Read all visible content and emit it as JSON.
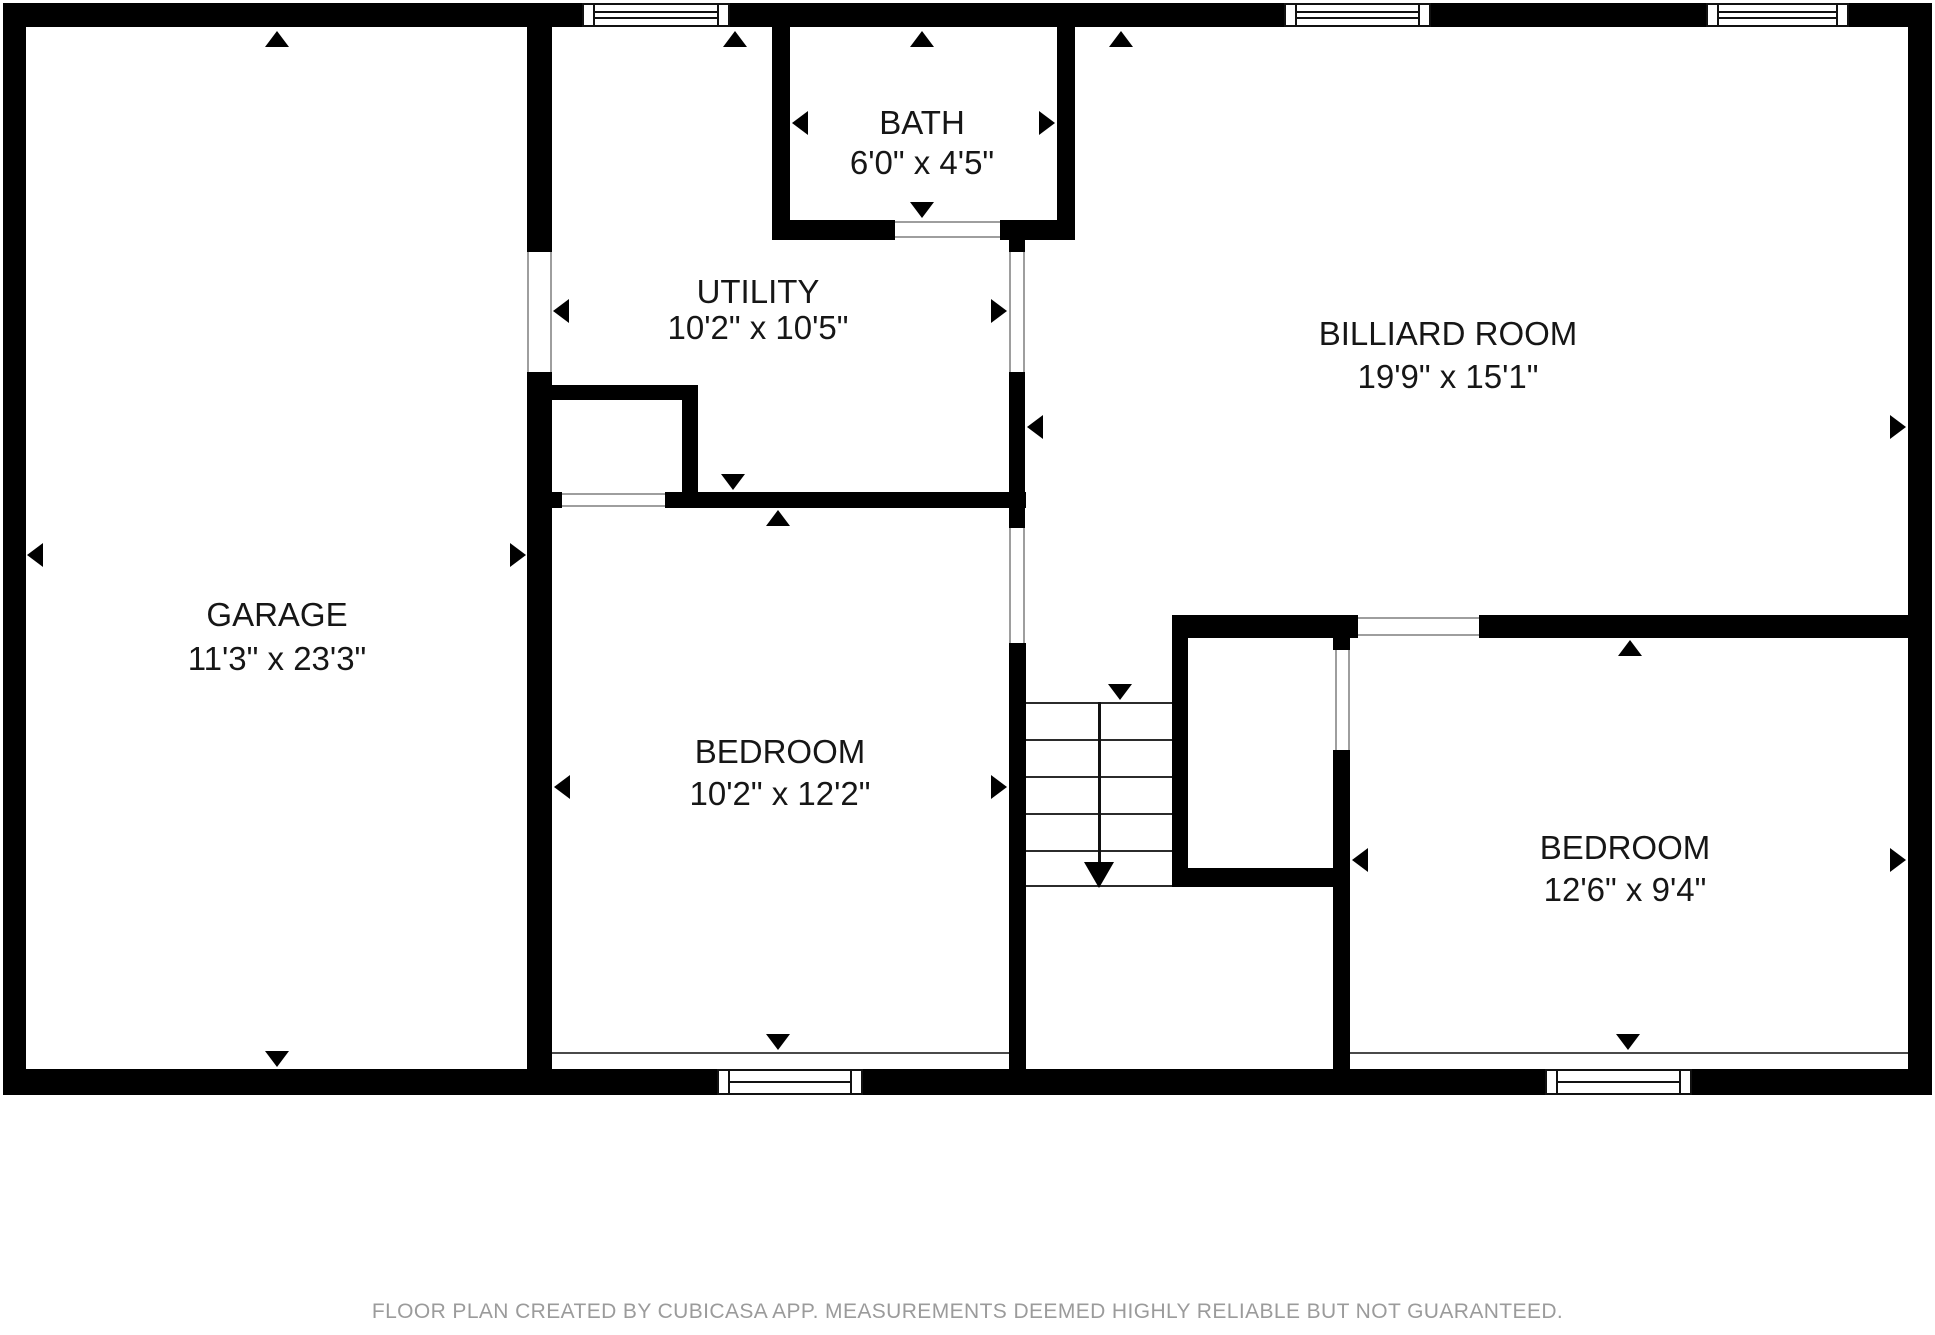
{
  "footer": {
    "text": "FLOOR PLAN CREATED BY CUBICASA APP. MEASUREMENTS DEEMED HIGHLY RELIABLE BUT NOT GUARANTEED.",
    "y": 1300
  },
  "colors": {
    "wall": "#000000",
    "background": "#ffffff",
    "label": "#161616",
    "footer_text": "#9b9b9b",
    "opening_line": "#9e9e9e",
    "floor_line": "#4a4a4a"
  },
  "canvas": {
    "width": 1935,
    "height": 1335
  },
  "plan": {
    "rooms": [
      {
        "id": "garage",
        "name": "GARAGE",
        "dims": "11'3\" x 23'3\"",
        "cx": 277,
        "name_y": 615,
        "dims_y": 659
      },
      {
        "id": "utility",
        "name": "UTILITY",
        "dims": "10'2\" x 10'5\"",
        "cx": 758,
        "name_y": 292,
        "dims_y": 328
      },
      {
        "id": "bath",
        "name": "BATH",
        "dims": "6'0\" x 4'5\"",
        "cx": 922,
        "name_y": 123,
        "dims_y": 163
      },
      {
        "id": "billiard-room",
        "name": "BILLIARD ROOM",
        "dims": "19'9\" x 15'1\"",
        "cx": 1448,
        "name_y": 334,
        "dims_y": 377
      },
      {
        "id": "bedroom-left",
        "name": "BEDROOM",
        "dims": "10'2\" x 12'2\"",
        "cx": 780,
        "name_y": 752,
        "dims_y": 794
      },
      {
        "id": "bedroom-right",
        "name": "BEDROOM",
        "dims": "12'6\" x 9'4\"",
        "cx": 1625,
        "name_y": 848,
        "dims_y": 890
      }
    ],
    "walls": [
      [
        3,
        3,
        579,
        24
      ],
      [
        730,
        3,
        554,
        24
      ],
      [
        1431,
        3,
        275,
        24
      ],
      [
        1849,
        3,
        83,
        24
      ],
      [
        3,
        3,
        23,
        1092
      ],
      [
        3,
        1069,
        714,
        26
      ],
      [
        863,
        1069,
        682,
        26
      ],
      [
        1692,
        1069,
        240,
        26
      ],
      [
        1908,
        3,
        24,
        1092
      ],
      [
        527,
        27,
        25,
        225
      ],
      [
        527,
        372,
        25,
        697
      ],
      [
        552,
        492,
        10,
        16
      ],
      [
        772,
        27,
        18,
        210
      ],
      [
        1057,
        27,
        18,
        210
      ],
      [
        772,
        220,
        123,
        20
      ],
      [
        1000,
        220,
        75,
        20
      ],
      [
        1009,
        237,
        16,
        15
      ],
      [
        1009,
        372,
        16,
        120
      ],
      [
        1009,
        508,
        16,
        20
      ],
      [
        1009,
        643,
        17,
        426
      ],
      [
        665,
        492,
        361,
        16
      ],
      [
        548,
        385,
        150,
        15
      ],
      [
        682,
        400,
        16,
        92
      ],
      [
        1172,
        615,
        186,
        23
      ],
      [
        1172,
        615,
        16,
        272
      ],
      [
        1172,
        868,
        178,
        19
      ],
      [
        1333,
        638,
        17,
        12
      ],
      [
        1333,
        750,
        17,
        137
      ],
      [
        1333,
        887,
        17,
        182
      ],
      [
        1479,
        615,
        429,
        23
      ]
    ],
    "opening_lines": [
      [
        527,
        252,
        2,
        120
      ],
      [
        550,
        252,
        2,
        120
      ],
      [
        1009,
        252,
        2,
        120
      ],
      [
        1023,
        252,
        2,
        120
      ],
      [
        1009,
        528,
        2,
        115
      ],
      [
        1023,
        528,
        2,
        115
      ],
      [
        895,
        221,
        105,
        2
      ],
      [
        895,
        236,
        105,
        2
      ],
      [
        562,
        493,
        103,
        2
      ],
      [
        562,
        505,
        103,
        2
      ],
      [
        1335,
        650,
        2,
        100
      ],
      [
        1348,
        650,
        2,
        100
      ],
      [
        1358,
        617,
        121,
        2
      ],
      [
        1358,
        634,
        121,
        2
      ]
    ],
    "floor_lines": [
      [
        552,
        1052,
        457,
        2
      ],
      [
        1350,
        1052,
        558,
        2
      ]
    ],
    "windows": [
      {
        "x": 582,
        "y": 3,
        "w": 148,
        "h": 24,
        "style": "double"
      },
      {
        "x": 1284,
        "y": 3,
        "w": 147,
        "h": 24,
        "style": "double"
      },
      {
        "x": 1706,
        "y": 3,
        "w": 143,
        "h": 24,
        "style": "double"
      },
      {
        "x": 717,
        "y": 1069,
        "w": 146,
        "h": 26,
        "style": "single"
      },
      {
        "x": 1545,
        "y": 1069,
        "w": 147,
        "h": 26,
        "style": "single"
      }
    ],
    "arrow_size": {
      "half": 12,
      "len": 16
    },
    "arrows": [
      {
        "x": 277,
        "y": 31,
        "dir": "up",
        "room": "garage"
      },
      {
        "x": 27,
        "y": 555,
        "dir": "left",
        "room": "garage"
      },
      {
        "x": 526,
        "y": 555,
        "dir": "right",
        "room": "garage"
      },
      {
        "x": 277,
        "y": 1067,
        "dir": "down",
        "room": "garage"
      },
      {
        "x": 735,
        "y": 31,
        "dir": "up",
        "room": "utility"
      },
      {
        "x": 553,
        "y": 311,
        "dir": "left",
        "room": "utility"
      },
      {
        "x": 1007,
        "y": 311,
        "dir": "right",
        "room": "utility"
      },
      {
        "x": 733,
        "y": 490,
        "dir": "down",
        "room": "utility"
      },
      {
        "x": 922,
        "y": 31,
        "dir": "up",
        "room": "bath"
      },
      {
        "x": 792,
        "y": 123,
        "dir": "left",
        "room": "bath"
      },
      {
        "x": 1055,
        "y": 123,
        "dir": "right",
        "room": "bath"
      },
      {
        "x": 922,
        "y": 218,
        "dir": "down",
        "room": "bath"
      },
      {
        "x": 1121,
        "y": 31,
        "dir": "up",
        "room": "billiard-room"
      },
      {
        "x": 1027,
        "y": 427,
        "dir": "left",
        "room": "billiard-room"
      },
      {
        "x": 1906,
        "y": 427,
        "dir": "right",
        "room": "billiard-room"
      },
      {
        "x": 1120,
        "y": 700,
        "dir": "down",
        "room": "billiard-room"
      },
      {
        "x": 778,
        "y": 510,
        "dir": "up",
        "room": "bedroom-left"
      },
      {
        "x": 554,
        "y": 787,
        "dir": "left",
        "room": "bedroom-left"
      },
      {
        "x": 1007,
        "y": 787,
        "dir": "right",
        "room": "bedroom-left"
      },
      {
        "x": 778,
        "y": 1050,
        "dir": "down",
        "room": "bedroom-left"
      },
      {
        "x": 1630,
        "y": 640,
        "dir": "up",
        "room": "bedroom-right"
      },
      {
        "x": 1352,
        "y": 860,
        "dir": "left",
        "room": "bedroom-right"
      },
      {
        "x": 1906,
        "y": 860,
        "dir": "right",
        "room": "bedroom-right"
      },
      {
        "x": 1628,
        "y": 1050,
        "dir": "down",
        "room": "bedroom-right"
      }
    ],
    "stairs": {
      "x": 1026,
      "w": 146,
      "tread_ys": [
        702,
        739,
        776,
        813,
        850,
        885
      ],
      "run_x": 1098,
      "run_y1": 702,
      "run_y2": 862,
      "head": {
        "x": 1099,
        "y": 888,
        "half": 15,
        "len": 26
      }
    }
  }
}
